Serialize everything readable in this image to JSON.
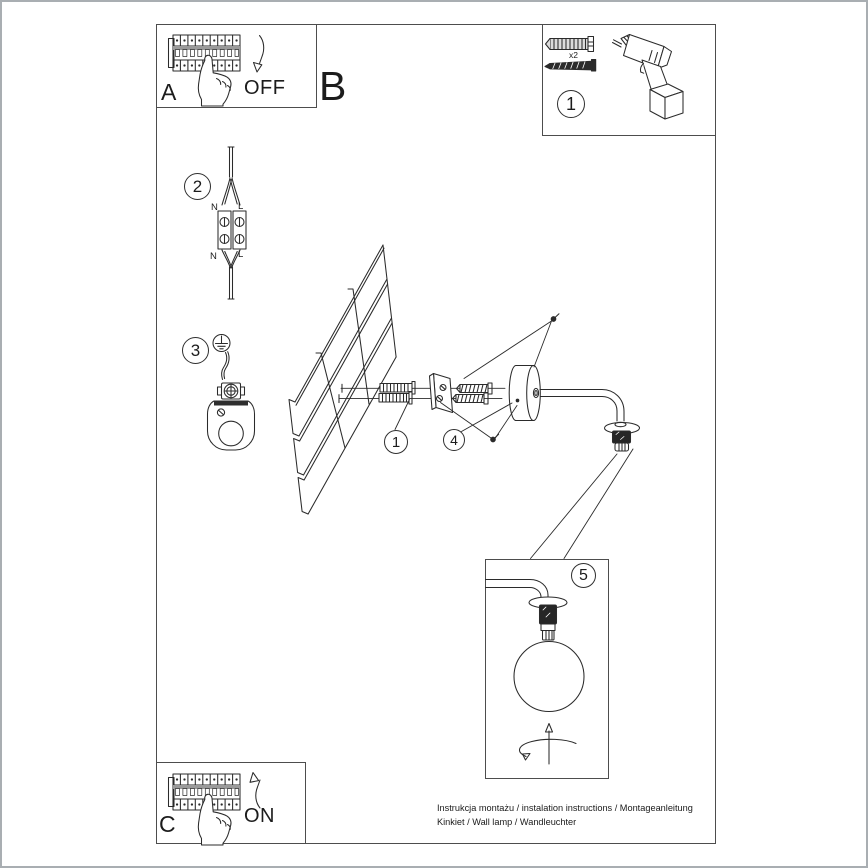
{
  "document": {
    "steps": {
      "a": "A",
      "b": "B",
      "c": "C"
    },
    "switch": {
      "off": "OFF",
      "on": "ON"
    },
    "callouts": {
      "hardware": "1",
      "wiring": "2",
      "ground": "3",
      "anchors": "1",
      "bracket": "4",
      "shade": "5"
    },
    "hardware": {
      "anchor_qty": "x2"
    },
    "wiring": {
      "n_in": "N",
      "l_in": "L",
      "n_out": "N",
      "l_out": "L"
    },
    "footer": {
      "line1": "Instrukcja montażu / instalation instructions / Montageanleitung",
      "line2": "Kinkiet / Wall lamp / Wandleuchter"
    },
    "icons": {
      "breaker_off": "circuit-breaker-panel-icon",
      "breaker_on": "circuit-breaker-panel-icon",
      "hand": "pointing-hand-icon",
      "arrow_off": "curved-arrow-down-icon",
      "arrow_on": "curved-arrow-up-icon",
      "anchor": "wall-plug-icon",
      "screw": "screw-icon",
      "drill": "drill-icon",
      "terminal": "terminal-block-icon",
      "ground": "earth-symbol-icon",
      "bracket_cup": "mounting-cup-icon",
      "wall": "wall-panel-icon",
      "canopy": "canopy-arm-icon",
      "globe": "globe-shade-icon",
      "rotate": "rotate-arrow-icon"
    },
    "colors": {
      "line": "#2b2b2b",
      "frame": "#4d4d4d",
      "page_border": "#a9aeb2",
      "background": "#ffffff"
    }
  }
}
